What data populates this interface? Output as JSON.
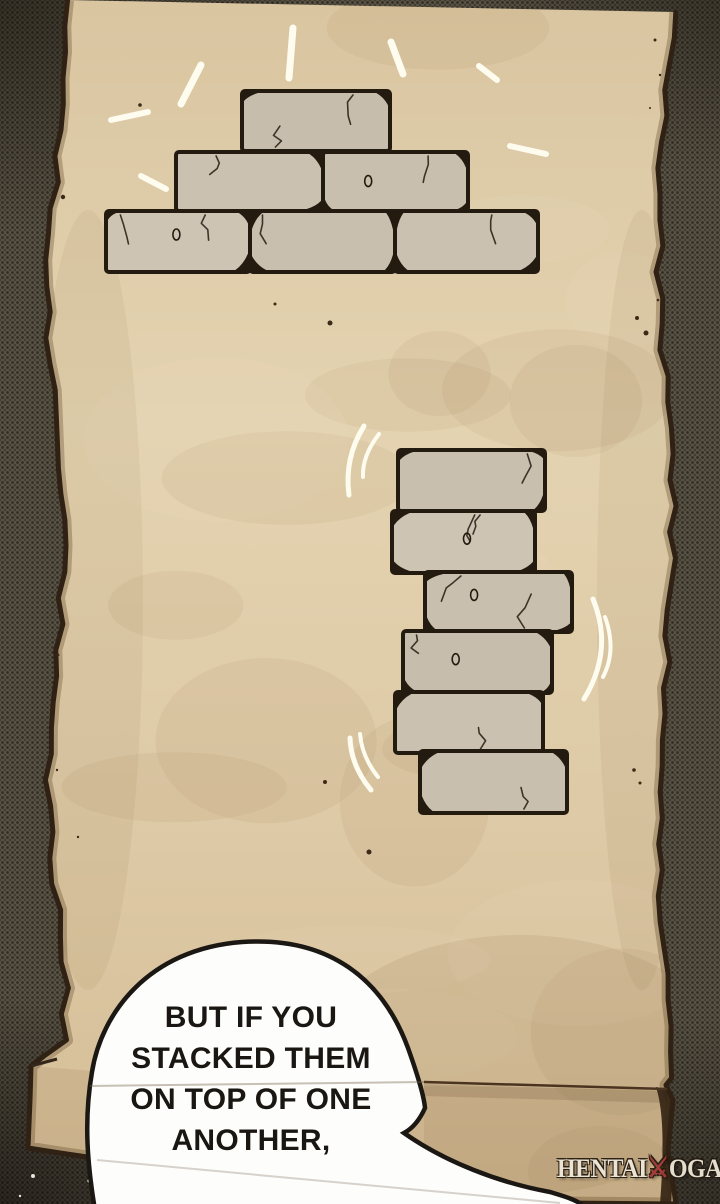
{
  "page": {
    "speech_bubble": {
      "text": "BUT IF YOU\nSTACKED THEM\nON TOP OF ONE\nANOTHER,"
    },
    "watermark": {
      "prefix": "HENTAI",
      "icon": "crossed-swords-icon",
      "icon_glyph": "⚔",
      "suffix": "OGA"
    },
    "illustration": {
      "pyramid_brick_count": 6,
      "stacked_brick_count": 6
    },
    "colors": {
      "background": "#5a5446",
      "background_dot": "#332e25",
      "parchment": "#ddc9a5",
      "parchment_light": "#e4d3b1",
      "parchment_dark": "#d4bd96",
      "parchment_edge": "#2f2113",
      "brick_fill": "#c9bfae",
      "brick_outline": "#241b10",
      "bubble_fill": "#fdfdfb",
      "bubble_outline": "#1b1713",
      "text_color": "#1a1713",
      "effect_white": "#fffdf2",
      "roll_line": "#4a3420"
    }
  }
}
